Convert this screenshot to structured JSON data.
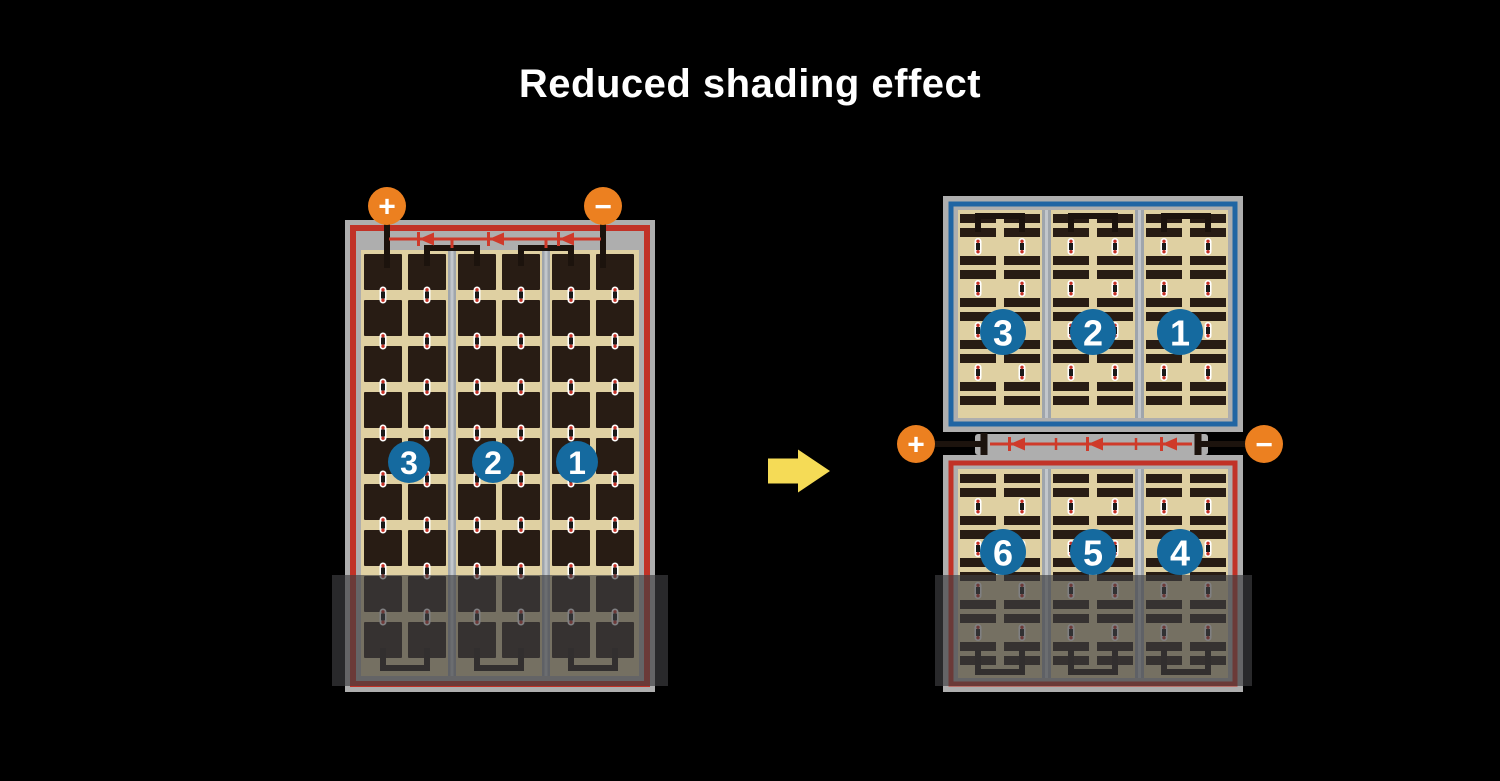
{
  "title": "Reduced shading effect",
  "colors": {
    "background": "#000000",
    "frame_gray": "#AEAEAE",
    "divider_gray": "#9FA5AC",
    "divider_highlight": "#C2C6CB",
    "cell_field_tan": "#DFD0A2",
    "cell_dark": "#281C14",
    "wire_black": "#1C130D",
    "circuit_red": "#C13227",
    "diode_red": "#CF3A2A",
    "border_blue": "#2065A3",
    "badge_blue": "#156A9F",
    "terminal_orange": "#EC8020",
    "arrow_yellow": "#F5DB56",
    "pill_white": "#FFFFFF",
    "pill_dot_red": "#C43026",
    "shade_overlay": "rgba(62,62,66,0.66)"
  },
  "left_panel": {
    "description": "full-cell module with shaded bottom",
    "terminals": [
      {
        "symbol": "+"
      },
      {
        "symbol": "−"
      }
    ],
    "strings": [
      {
        "label": "3"
      },
      {
        "label": "2"
      },
      {
        "label": "1"
      }
    ],
    "diode_count": 3,
    "shaded": true
  },
  "right_panel": {
    "description": "half-cut twin module with shaded bottom",
    "terminals": [
      {
        "symbol": "+"
      },
      {
        "symbol": "−"
      }
    ],
    "top_half": {
      "strings": [
        {
          "label": "3"
        },
        {
          "label": "2"
        },
        {
          "label": "1"
        }
      ]
    },
    "bottom_half": {
      "strings": [
        {
          "label": "6"
        },
        {
          "label": "5"
        },
        {
          "label": "4"
        }
      ]
    },
    "diode_count": 3,
    "shaded": true
  },
  "arrow": {
    "direction": "right"
  }
}
